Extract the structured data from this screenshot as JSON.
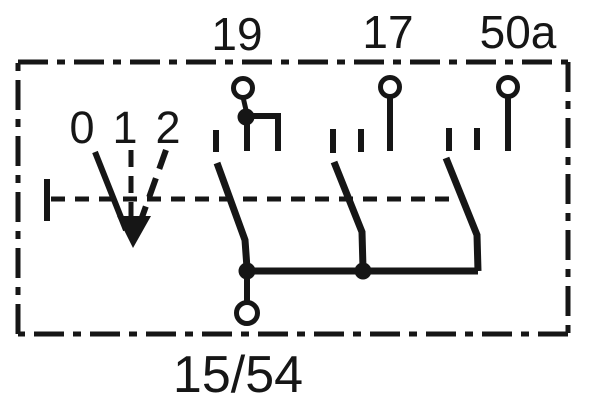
{
  "diagram": {
    "kind": "switch-contact-schematic",
    "colors": {
      "line": "#161616",
      "background": "#ffffff"
    },
    "top_terminals": [
      {
        "label": "19"
      },
      {
        "label": "17"
      },
      {
        "label": "50a"
      }
    ],
    "bottom_terminal": {
      "label": "15/54"
    },
    "switch_positions": [
      {
        "label": "0"
      },
      {
        "label": "1"
      },
      {
        "label": "2"
      }
    ]
  }
}
